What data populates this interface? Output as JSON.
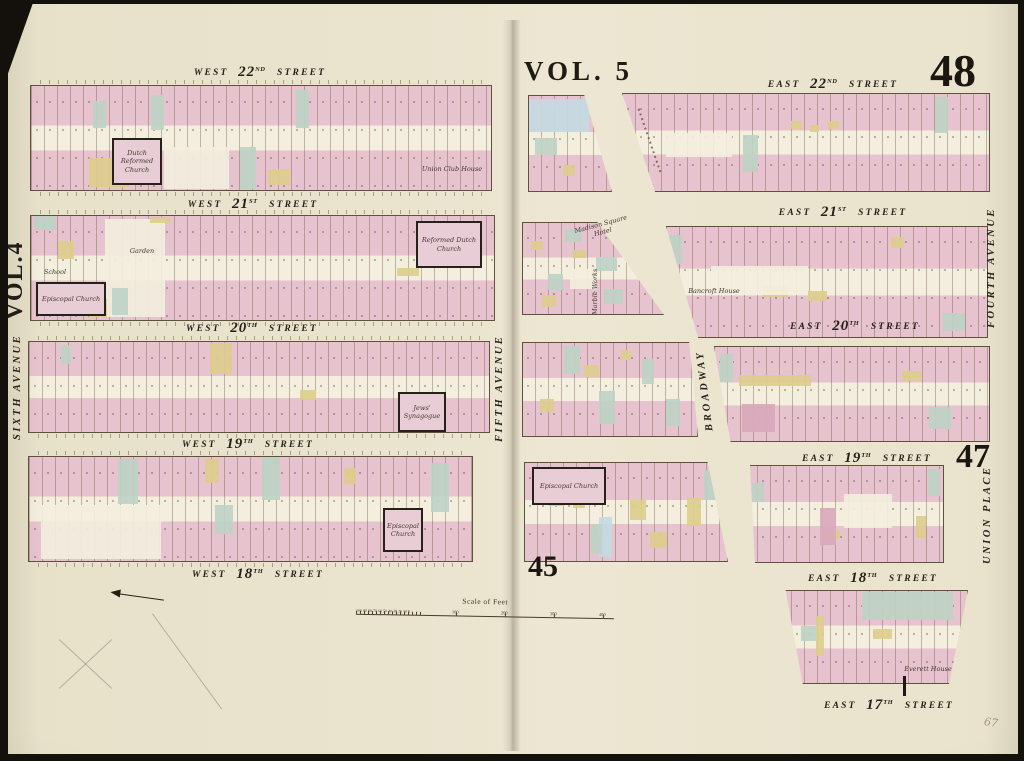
{
  "map": {
    "left_volume": "VOL.4",
    "right_volume": "VOL. 5",
    "plates": {
      "top_right": "48",
      "middle_right": "47",
      "bottom_left": "45"
    },
    "pencil_note": "67"
  },
  "streets": {
    "west22": {
      "dir": "WEST",
      "num": "22",
      "ord": "ND",
      "word": "STREET"
    },
    "west21": {
      "dir": "WEST",
      "num": "21",
      "ord": "ST",
      "word": "STREET"
    },
    "west20": {
      "dir": "WEST",
      "num": "20",
      "ord": "TH",
      "word": "STREET"
    },
    "west19": {
      "dir": "WEST",
      "num": "19",
      "ord": "TH",
      "word": "STREET"
    },
    "west18": {
      "dir": "WEST",
      "num": "18",
      "ord": "TH",
      "word": "STREET"
    },
    "east22": {
      "dir": "EAST",
      "num": "22",
      "ord": "ND",
      "word": "STREET"
    },
    "east21": {
      "dir": "EAST",
      "num": "21",
      "ord": "ST",
      "word": "STREET"
    },
    "east20": {
      "dir": "EAST",
      "num": "20",
      "ord": "TH",
      "word": "STREET"
    },
    "east19": {
      "dir": "EAST",
      "num": "19",
      "ord": "TH",
      "word": "STREET"
    },
    "east18": {
      "dir": "EAST",
      "num": "18",
      "ord": "TH",
      "word": "STREET"
    },
    "east17": {
      "dir": "EAST",
      "num": "17",
      "ord": "TH",
      "word": "STREET"
    }
  },
  "avenues": {
    "sixth": "SIXTH AVENUE",
    "fifth": "FIFTH AVENUE",
    "fourth": "FOURTH AVENUE",
    "broadway": "BROADWAY",
    "union_place": "UNION PLACE"
  },
  "buildings": {
    "dutch_reformed_church": "Dutch Reformed Church",
    "union_club_house": "Union Club House",
    "garden": "Garden",
    "reformed_dutch_church": "Reformed Dutch Church",
    "school": "School",
    "episcopal_church_w20": "Episcopal Church",
    "jews_synagogue": "Jews' Synagogue",
    "episcopal_church_w18": "Episcopal Church",
    "madison_square_hotel": "Madison Square Hotel",
    "marble_works": "Marble Works",
    "bancroft_house": "Bancroft House",
    "episcopal_church_e19": "Episcopal Church",
    "everett_house": "Everett House"
  },
  "scale": {
    "label": "Scale of Feet",
    "minor": "100 90 80 70 60 50 40 30 20 10 0",
    "major": [
      "100",
      "200",
      "300",
      "400"
    ]
  },
  "colors": {
    "paper": "#eae4cf",
    "lot_pink": "#e7c3cf",
    "lot_green": "#bfd3c5",
    "lot_yellow": "#ddcd8d",
    "lot_blue": "#c5dae3",
    "ink": "#2a241c"
  }
}
